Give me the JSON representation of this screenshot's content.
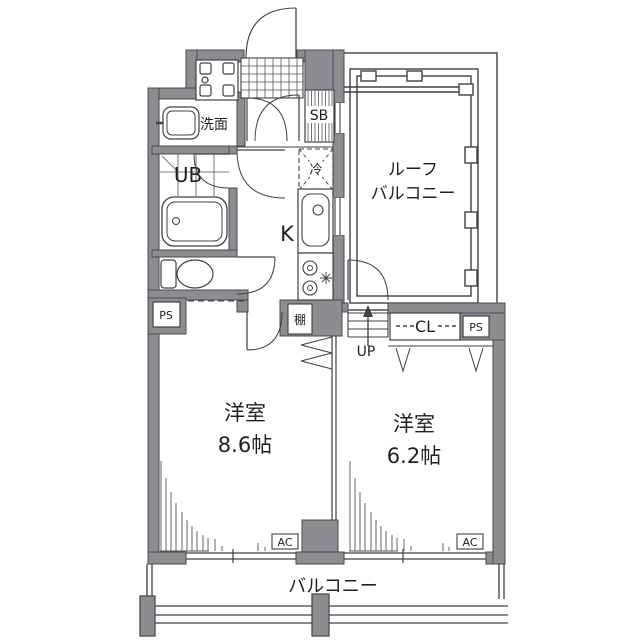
{
  "colors": {
    "background": "#ffffff",
    "wall_fill": "#8d8d91",
    "wall_stroke": "#4a4a4f",
    "line": "#404045",
    "text": "#1f1f22"
  },
  "labels": {
    "washroom": "洗面",
    "unit_bath": "UB",
    "kitchen": "K",
    "shoe_box": "SB",
    "refrigerator": "冷",
    "shelf": "棚",
    "stairs_up": "UP",
    "closet": "CL",
    "pipe_space": "PS",
    "roof_balcony_line1": "ルーフ",
    "roof_balcony_line2": "バルコニー",
    "room1_name": "洋室",
    "room1_size": "8.6帖",
    "room2_name": "洋室",
    "room2_size": "6.2帖",
    "balcony": "バルコニー",
    "ac": "AC"
  }
}
